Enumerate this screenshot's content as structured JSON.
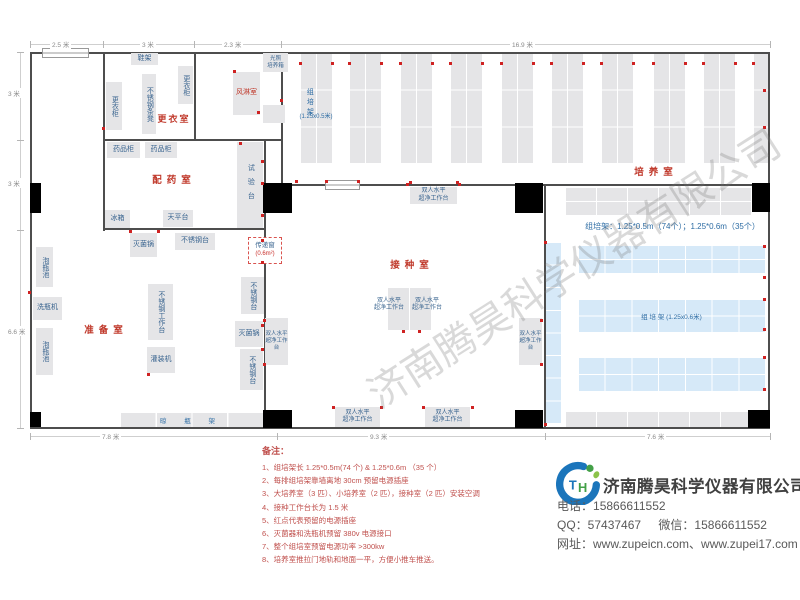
{
  "watermark": "济南腾昊科学仪器有限公司",
  "colors": {
    "wall": "#4d4d4d",
    "rack_gray": "#e5e5e7",
    "rack_blue": "#d6e9f8",
    "equip_text": "#39648f",
    "room_label_red": "#c0392b",
    "note_red": "#c0504d",
    "outlet_red": "#cf2222",
    "dim_gray": "#8a8a8a"
  },
  "passbox": {
    "line1": "传递窗",
    "line2": "(0.6m²)"
  },
  "texts": [
    {
      "n": "room-label-dressing",
      "t": "更衣室",
      "x": 152,
      "y": 114,
      "w": 44,
      "fs": 9,
      "c": "#c0392b",
      "b": 1,
      "ls": 2
    },
    {
      "n": "room-label-pharmacy",
      "t": "配药室",
      "x": 146,
      "y": 175,
      "w": 56,
      "fs": 9.5,
      "c": "#c0392b",
      "b": 1,
      "ls": 5
    },
    {
      "n": "room-label-prep",
      "t": "准备室",
      "x": 78,
      "y": 325,
      "w": 56,
      "fs": 9.5,
      "c": "#c0392b",
      "b": 1,
      "ls": 5
    },
    {
      "n": "room-label-inoculation",
      "t": "接种室",
      "x": 384,
      "y": 260,
      "w": 56,
      "fs": 9.5,
      "c": "#c0392b",
      "b": 1,
      "ls": 5
    },
    {
      "n": "room-label-culture",
      "t": "培养室",
      "x": 628,
      "y": 167,
      "w": 56,
      "fs": 9.5,
      "c": "#c0392b",
      "b": 1,
      "ls": 5
    },
    {
      "n": "rack-column-label",
      "t": "组培架",
      "x": 305,
      "y": 88,
      "fs": 7,
      "c": "#2e6da4",
      "v": 1,
      "ls": 3
    },
    {
      "n": "rack-column-size",
      "t": "(1.25x0.5米)",
      "x": 292,
      "y": 114,
      "w": 48,
      "fs": 6,
      "c": "#2e6da4"
    },
    {
      "n": "rack-spec-label",
      "t": "组培架：1.25*0.5m（74个）；1.25*0.6m（35个）",
      "x": 570,
      "y": 222,
      "w": 205,
      "fs": 8,
      "c": "#2e6da4"
    },
    {
      "n": "clean-bench-label-center-left",
      "t": "双人水平\n超净工作台",
      "x": 369,
      "y": 298,
      "w": 40,
      "fs": 6,
      "c": "#39648f"
    },
    {
      "n": "clean-bench-label-center-right",
      "t": "双人水平\n超净工作台",
      "x": 407,
      "y": 298,
      "w": 40,
      "fs": 6,
      "c": "#39648f"
    }
  ],
  "equipment": [
    {
      "n": "shoe-rack",
      "t": "鞋架",
      "x": 131,
      "y": 53,
      "w": 27,
      "h": 12
    },
    {
      "n": "locker-right",
      "t": "更衣柜",
      "x": 178,
      "y": 66,
      "w": 15,
      "h": 38,
      "v": 1
    },
    {
      "n": "steel-bench-stool",
      "t": "不锈钢条凳",
      "x": 142,
      "y": 74,
      "w": 14,
      "h": 60,
      "v": 1
    },
    {
      "n": "locker-left",
      "t": "更衣柜",
      "x": 106,
      "y": 82,
      "w": 16,
      "h": 48,
      "v": 1
    },
    {
      "n": "air-shower-room",
      "t": "风淋室",
      "x": 233,
      "y": 72,
      "w": 27,
      "h": 43,
      "c": "#c0392b",
      "fs": 7
    },
    {
      "n": "light-incubator",
      "t": "光照\n培养箱",
      "x": 263,
      "y": 53,
      "w": 25,
      "h": 19,
      "fs": 5.5
    },
    {
      "n": "incubator-2",
      "t": "",
      "x": 263,
      "y": 105,
      "w": 22,
      "h": 18
    },
    {
      "n": "medicine-cabinet-1",
      "t": "药品柜",
      "x": 107,
      "y": 142,
      "w": 33,
      "h": 16
    },
    {
      "n": "medicine-cabinet-2",
      "t": "药品柜",
      "x": 145,
      "y": 142,
      "w": 32,
      "h": 16
    },
    {
      "n": "test-bench",
      "t": "试验台",
      "x": 237,
      "y": 142,
      "w": 26,
      "h": 86,
      "v": 1,
      "ls": 7
    },
    {
      "n": "fridge",
      "t": "冰箱",
      "x": 105,
      "y": 210,
      "w": 25,
      "h": 18
    },
    {
      "n": "balance-table",
      "t": "天平台",
      "x": 163,
      "y": 210,
      "w": 30,
      "h": 17
    },
    {
      "n": "sterilizer-1",
      "t": "灭菌锅",
      "x": 130,
      "y": 233,
      "w": 27,
      "h": 24
    },
    {
      "n": "steel-table-1",
      "t": "不锈钢台",
      "x": 175,
      "y": 233,
      "w": 40,
      "h": 17
    },
    {
      "n": "soak-pool-1",
      "t": "泡瓶池",
      "x": 36,
      "y": 247,
      "w": 17,
      "h": 40,
      "v": 1
    },
    {
      "n": "bottle-washer",
      "t": "洗瓶机",
      "x": 33,
      "y": 297,
      "w": 29,
      "h": 23
    },
    {
      "n": "soak-pool-2",
      "t": "泡瓶池",
      "x": 36,
      "y": 328,
      "w": 17,
      "h": 47,
      "v": 1
    },
    {
      "n": "steel-workbench",
      "t": "不锈钢工作台",
      "x": 148,
      "y": 284,
      "w": 25,
      "h": 56,
      "v": 1
    },
    {
      "n": "filling-machine",
      "t": "灌装机",
      "x": 147,
      "y": 347,
      "w": 28,
      "h": 26
    },
    {
      "n": "steel-table-2",
      "t": "不锈钢台",
      "x": 241,
      "y": 277,
      "w": 23,
      "h": 37,
      "v": 1
    },
    {
      "n": "sterilizer-2",
      "t": "灭菌锅",
      "x": 235,
      "y": 321,
      "w": 28,
      "h": 26
    },
    {
      "n": "steel-table-3",
      "t": "不锈钢台",
      "x": 240,
      "y": 349,
      "w": 23,
      "h": 41,
      "v": 1
    },
    {
      "n": "clean-bench-top",
      "t": "双人水平\n超净工作台",
      "x": 410,
      "y": 187,
      "w": 47,
      "h": 17,
      "fs": 6
    },
    {
      "n": "clean-bench-center-left-box",
      "t": "",
      "x": 388,
      "y": 288,
      "w": 21,
      "h": 42
    },
    {
      "n": "clean-bench-center-right-box",
      "t": "",
      "x": 410,
      "y": 288,
      "w": 21,
      "h": 42
    },
    {
      "n": "clean-bench-left",
      "t": "双人水平\n超净工作台",
      "x": 265,
      "y": 318,
      "w": 23,
      "h": 47,
      "fs": 5.5
    },
    {
      "n": "clean-bench-right",
      "t": "双人水平\n超净工作台",
      "x": 519,
      "y": 318,
      "w": 23,
      "h": 47,
      "fs": 5.5
    },
    {
      "n": "clean-bench-bottom-1",
      "t": "双人水平\n超净工作台",
      "x": 335,
      "y": 407,
      "w": 45,
      "h": 20,
      "fs": 6
    },
    {
      "n": "clean-bench-bottom-2",
      "t": "双人水平\n超净工作台",
      "x": 425,
      "y": 407,
      "w": 45,
      "h": 20,
      "fs": 6
    }
  ],
  "racks": [
    {
      "n": "culture-rack-col-1",
      "x": 300,
      "y": 53,
      "w": 32,
      "h": 110,
      "rows": 3,
      "cols": 2,
      "c": "gray"
    },
    {
      "n": "culture-rack-col-2",
      "x": 349,
      "y": 53,
      "w": 32,
      "h": 110,
      "rows": 3,
      "cols": 2,
      "c": "gray"
    },
    {
      "n": "culture-rack-col-3",
      "x": 400,
      "y": 53,
      "w": 32,
      "h": 110,
      "rows": 3,
      "cols": 2,
      "c": "gray"
    },
    {
      "n": "culture-rack-col-4",
      "x": 450,
      "y": 53,
      "w": 32,
      "h": 110,
      "rows": 3,
      "cols": 2,
      "c": "gray"
    },
    {
      "n": "culture-rack-col-5",
      "x": 501,
      "y": 53,
      "w": 32,
      "h": 110,
      "rows": 3,
      "cols": 2,
      "c": "gray"
    },
    {
      "n": "culture-rack-col-6",
      "x": 551,
      "y": 53,
      "w": 32,
      "h": 110,
      "rows": 3,
      "cols": 2,
      "c": "gray"
    },
    {
      "n": "culture-rack-col-7",
      "x": 601,
      "y": 53,
      "w": 32,
      "h": 110,
      "rows": 3,
      "cols": 2,
      "c": "gray"
    },
    {
      "n": "culture-rack-col-8",
      "x": 653,
      "y": 53,
      "w": 32,
      "h": 110,
      "rows": 3,
      "cols": 2,
      "c": "gray"
    },
    {
      "n": "culture-rack-col-9",
      "x": 703,
      "y": 53,
      "w": 32,
      "h": 110,
      "rows": 3,
      "cols": 2,
      "c": "gray"
    },
    {
      "n": "culture-rack-col-10",
      "x": 753,
      "y": 53,
      "w": 17,
      "h": 110,
      "rows": 3,
      "cols": 1,
      "c": "gray"
    },
    {
      "n": "rack-top-small-room",
      "x": 565,
      "y": 187,
      "w": 186,
      "h": 28,
      "rows": 2,
      "cols": 6,
      "c": "gray"
    },
    {
      "n": "rack-bottom-small-room",
      "x": 565,
      "y": 411,
      "w": 186,
      "h": 16,
      "rows": 1,
      "cols": 6,
      "c": "gray"
    },
    {
      "n": "bottle-drying-rack",
      "x": 120,
      "y": 412,
      "w": 143,
      "h": 16,
      "rows": 1,
      "cols": 4,
      "c": "gray",
      "label": "晾 瓶 架",
      "lls": 8
    },
    {
      "n": "blue-rack-vertical",
      "x": 545,
      "y": 242,
      "w": 16,
      "h": 181,
      "rows": 8,
      "cols": 1,
      "c": "blue"
    },
    {
      "n": "blue-rack-h1",
      "x": 578,
      "y": 245,
      "w": 187,
      "h": 28,
      "rows": 2,
      "cols": 7,
      "c": "blue"
    },
    {
      "n": "blue-rack-h2",
      "x": 578,
      "y": 299,
      "w": 187,
      "h": 33,
      "rows": 2,
      "cols": 7,
      "c": "blue",
      "label": "组 培 架 (1.25x0.6米)"
    },
    {
      "n": "blue-rack-h3",
      "x": 578,
      "y": 357,
      "w": 187,
      "h": 34,
      "rows": 2,
      "cols": 7,
      "c": "blue"
    }
  ],
  "outlets": [
    [
      300,
      63
    ],
    [
      332,
      63
    ],
    [
      349,
      63
    ],
    [
      381,
      63
    ],
    [
      400,
      63
    ],
    [
      432,
      63
    ],
    [
      450,
      63
    ],
    [
      482,
      63
    ],
    [
      501,
      63
    ],
    [
      533,
      63
    ],
    [
      551,
      63
    ],
    [
      583,
      63
    ],
    [
      601,
      63
    ],
    [
      633,
      63
    ],
    [
      653,
      63
    ],
    [
      685,
      63
    ],
    [
      703,
      63
    ],
    [
      735,
      63
    ],
    [
      753,
      63
    ],
    [
      296,
      181
    ],
    [
      326,
      181
    ],
    [
      358,
      181
    ],
    [
      410,
      182
    ],
    [
      457,
      182
    ],
    [
      764,
      90
    ],
    [
      764,
      127
    ],
    [
      764,
      246
    ],
    [
      764,
      277
    ],
    [
      764,
      299
    ],
    [
      764,
      329
    ],
    [
      764,
      357
    ],
    [
      764,
      389
    ],
    [
      403,
      331
    ],
    [
      419,
      331
    ],
    [
      264,
      320
    ],
    [
      264,
      364
    ],
    [
      541,
      320
    ],
    [
      541,
      364
    ],
    [
      333,
      407
    ],
    [
      381,
      407
    ],
    [
      423,
      407
    ],
    [
      472,
      407
    ],
    [
      407,
      184
    ],
    [
      459,
      184
    ],
    [
      29,
      292
    ],
    [
      148,
      374
    ],
    [
      262,
      325
    ],
    [
      262,
      349
    ],
    [
      103,
      128
    ],
    [
      240,
      143
    ],
    [
      262,
      161
    ],
    [
      262,
      183
    ],
    [
      262,
      215
    ],
    [
      262,
      240
    ],
    [
      262,
      262
    ],
    [
      130,
      231
    ],
    [
      158,
      231
    ],
    [
      234,
      71
    ],
    [
      258,
      112
    ],
    [
      281,
      100
    ],
    [
      545,
      242
    ],
    [
      545,
      424
    ]
  ],
  "dims": {
    "top": {
      "y": 44,
      "x1": 30,
      "x2": 770,
      "ticks": [
        30,
        103,
        194,
        281,
        770
      ],
      "labels": [
        {
          "t": "2.5 米",
          "x": 50
        },
        {
          "t": "3 米",
          "x": 140
        },
        {
          "t": "2.3 米",
          "x": 222
        },
        {
          "t": "16.9 米",
          "x": 510
        }
      ]
    },
    "left": {
      "x": 20,
      "y1": 52,
      "y2": 428,
      "ticks": [
        52,
        140,
        230,
        428
      ],
      "labels": [
        {
          "t": "3 米",
          "y": 88
        },
        {
          "t": "3 米",
          "y": 178
        },
        {
          "t": "6.6 米",
          "y": 326
        }
      ]
    },
    "bottom": {
      "y": 436,
      "x1": 30,
      "x2": 770,
      "ticks": [
        30,
        277,
        545,
        770
      ],
      "labels": [
        {
          "t": "7.8 米",
          "x": 100
        },
        {
          "t": "9.3 米",
          "x": 368
        },
        {
          "t": "7.6 米",
          "x": 645
        }
      ]
    }
  },
  "notes": {
    "title": "备注：",
    "items": [
      "1、组培架长 1.25*0.5m(74 个) & 1.25*0.6m （35 个）",
      "2、每排组培架靠墙离地 30cm 预留电源插座",
      "3、大培养室（3 匹）、小培养室（2 匹），接种室（2 匹）安装空调",
      "4、接种工作台长为 1.5 米",
      "5、红点代表预留的电源插座",
      "6、灭菌器和洗瓶机预留 380v 电源接口",
      "7、整个组培室预留电源功率 >300kw",
      "8、培养室推拉门地轨和地面一平，方便小推车推送。"
    ]
  },
  "company": {
    "name": "济南腾昊科学仪器有限公司",
    "phone_label": "电话：",
    "phone": "15866611552",
    "qq_label": "QQ：",
    "qq": "57437467",
    "wechat_label": "微信：",
    "wechat": "15866611552",
    "web_label": "网址：",
    "websites": "www.zupeicn.com、www.zupei17.com"
  }
}
